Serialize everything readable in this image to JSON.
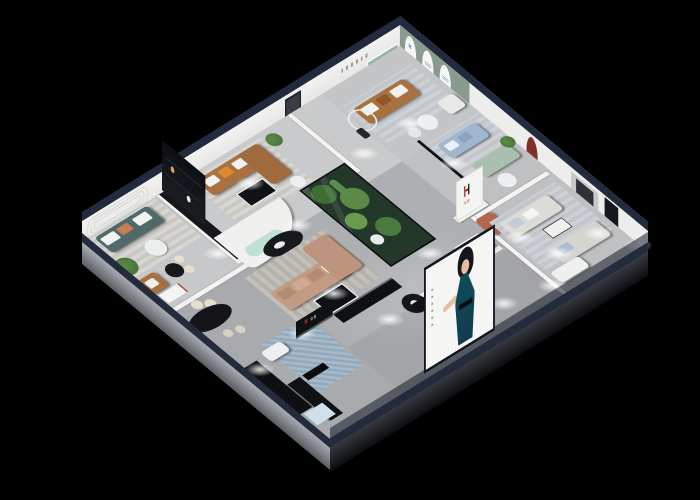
{
  "scene": {
    "description": "Isometric dollhouse cutaway 3D render of a furniture brand showroom at night, viewed from above; pure black background; navy-blue exterior wall rims; light gray floors lit by white ceiling spotlights; many furnished room vignettes.",
    "background_color": "#000000",
    "shell": {
      "rim_color": "#222b3d",
      "floor_color": "#b3b5b8",
      "far_wall_color": "#efefee",
      "front_left_base": "silver gray slab",
      "front_right_base": "dark charcoal slab"
    }
  },
  "brand": {
    "logo_letter": "H",
    "logo_letter_colors": [
      "#c63b2f",
      "#15181d"
    ],
    "logo_characters": "华煦",
    "logo_characters_color": "#c63b2f",
    "appearances": [
      "white partition wall center-right",
      "black reception shelf sign at front",
      "blue mark on first arched wall panel"
    ]
  },
  "poster": {
    "location": "front storefront facade",
    "background": "#f5f5f3",
    "subject": "illustrated woman with black updo hair in dark teal halter evening dress, arm extended",
    "caption": "small vertical caption text (illegible)"
  },
  "rooms": [
    {
      "name": "west-lounge",
      "furniture": [
        "dark teal 3-seat sofa with white and terracotta pillows",
        "striped gray rug",
        "white round coffee table",
        "tall green plant",
        "caramel armchair",
        "black bistro table with cream chairs"
      ],
      "wall_feature": "embossed racetrack line wall decor"
    },
    {
      "name": "caramel-lounge",
      "furniture": [
        "caramel leather L-sofa with orange pillow",
        "tall black display partition",
        "white side table",
        "black and white coffee table"
      ],
      "wall_feature": "dark red arched niche with vase"
    },
    {
      "name": "curved-lounge",
      "furniture": [
        "white wave-top partition",
        "mint curved bench",
        "black oval coffee table"
      ]
    },
    {
      "name": "tan-sectional-area",
      "furniture": [
        "blush-tan sectional sofa with chaise",
        "black coffee table with white rim",
        "gray rug"
      ]
    },
    {
      "name": "indoor-garden",
      "feature": "glass-walled planting atrium with shrubs, cacti and white flowers"
    },
    {
      "name": "top-gallery",
      "furniture": [
        "caramel leather 3-seat sofa with white pillows",
        "white armchair",
        "two white round tables",
        "ring floor lamp",
        "dark sculpture"
      ],
      "wall_feature": "recessed green niche and small wall lettering (illegible)"
    },
    {
      "name": "arched-display-wall",
      "feature": "sage green wall with three white arched panels bearing small blue brand marks"
    },
    {
      "name": "blue-sofa-room",
      "furniture": [
        "powder blue fabric sofa",
        "mint green sofa",
        "white round table",
        "dark glass partition",
        "potted plant"
      ]
    },
    {
      "name": "right-showcase-room",
      "furniture": [
        "two light gray sofas",
        "white bench",
        "white coffee table",
        "media console with red brand accents"
      ],
      "wall_feature": "dark red arched niche, recessed TV panel, dark doorway"
    },
    {
      "name": "front-seating",
      "furniture": [
        "blue-gray leather armchairs",
        "ottoman",
        "round black side table",
        "black reception counter with brand sign",
        "white daybed"
      ]
    },
    {
      "name": "dining-corner",
      "furniture": [
        "black marble oval dining table",
        "cream upholstered chairs",
        "arched display shelf with red trim",
        "black sideboards",
        "TV panel",
        "light blue cabinet",
        "blue patterned rug"
      ]
    }
  ],
  "lighting": {
    "type": "white ceiling downlight pools on floors",
    "color": "#ffffff"
  }
}
